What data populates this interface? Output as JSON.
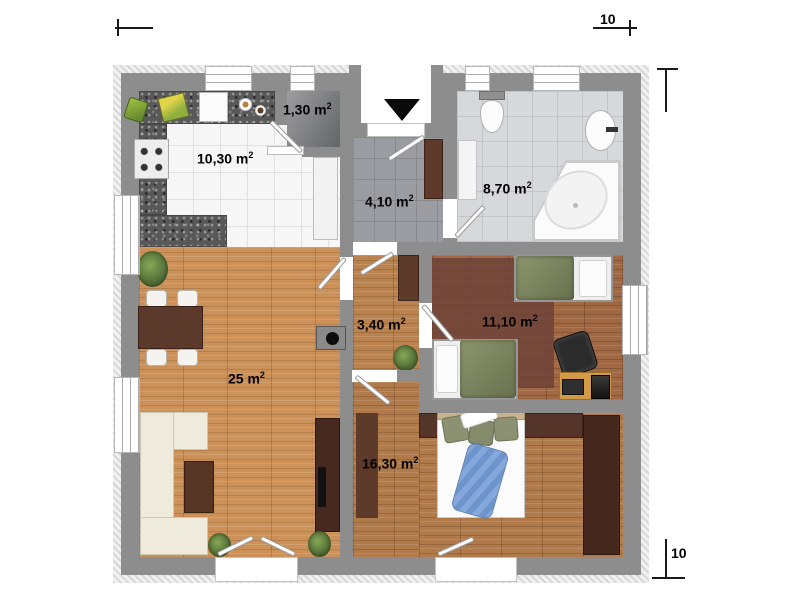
{
  "page": {
    "type": "apartment-floor-plan",
    "background": "#ffffff"
  },
  "rooms": [
    {
      "name": "kitchen",
      "area_label": "10,30 m",
      "area_sup": "2"
    },
    {
      "name": "pantry",
      "area_label": "1,30 m",
      "area_sup": "2"
    },
    {
      "name": "entrance-hall",
      "area_label": "4,10 m",
      "area_sup": "2"
    },
    {
      "name": "bathroom",
      "area_label": "8,70 m",
      "area_sup": "2"
    },
    {
      "name": "living-room",
      "area_label": "25 m",
      "area_sup": "2"
    },
    {
      "name": "corridor",
      "area_label": "3,40 m",
      "area_sup": "2"
    },
    {
      "name": "bedroom",
      "area_label": "11,10 m",
      "area_sup": "2"
    },
    {
      "name": "master-bedroom",
      "area_label": "16,30 m",
      "area_sup": "2"
    }
  ],
  "dimensions": {
    "top": "10",
    "right": "10"
  },
  "colors": {
    "wall": "#8d8d8d",
    "wood_light": "#cb9158",
    "wood_dark": "#a06944",
    "counter_granite": "#585858",
    "blanket_green": "#8b946d",
    "blanket_blue": "#7aa0d8",
    "tile_bath": "#d6d8dc"
  }
}
